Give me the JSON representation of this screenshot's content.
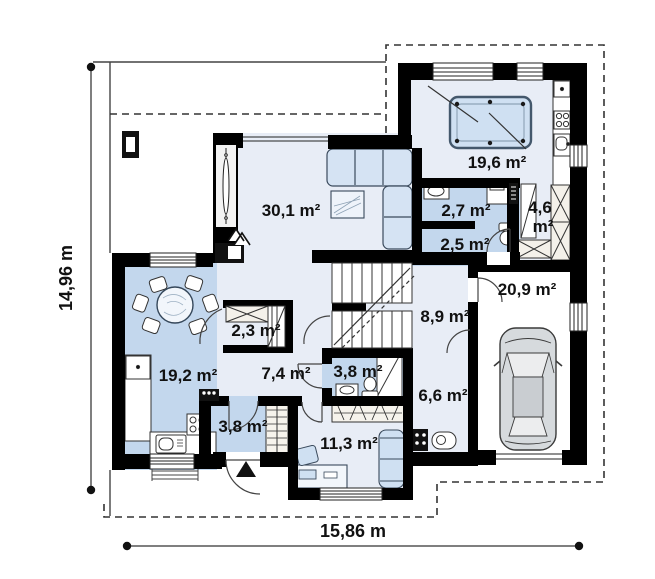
{
  "plan": {
    "type": "house-first-floor-plan",
    "dimensions": {
      "width_label": "15,86 m",
      "height_label": "14,96 m"
    },
    "rooms": [
      {
        "id": "living-room",
        "area": "30,1 m²"
      },
      {
        "id": "kitchen",
        "area": "19,6 m²"
      },
      {
        "id": "bathroom",
        "area": "2,7 m²"
      },
      {
        "id": "wc",
        "area": "2,5 m²"
      },
      {
        "id": "wardrobe",
        "area": "4,6 m²",
        "area_lines": [
          "4,6",
          "m²"
        ]
      },
      {
        "id": "garage",
        "area": "20,9 m²"
      },
      {
        "id": "stair-hall",
        "area": "8,9 m²"
      },
      {
        "id": "closet",
        "area": "2,3 m²"
      },
      {
        "id": "dining-room",
        "area": "19,2 m²"
      },
      {
        "id": "hallway",
        "area": "7,4 m²"
      },
      {
        "id": "entry",
        "area": "3,8 m²"
      },
      {
        "id": "bathroom-2",
        "area": "3,8 m²"
      },
      {
        "id": "utility-room",
        "area": "6,6 m²"
      },
      {
        "id": "study",
        "area": "11,3 m²"
      }
    ],
    "colors": {
      "wall": "#000000",
      "room_fill": "#e8edf6",
      "wet_room_fill": "#c3d7ed",
      "furniture_fill": "#cfe0f2",
      "outline_dashed": "#333333"
    }
  }
}
